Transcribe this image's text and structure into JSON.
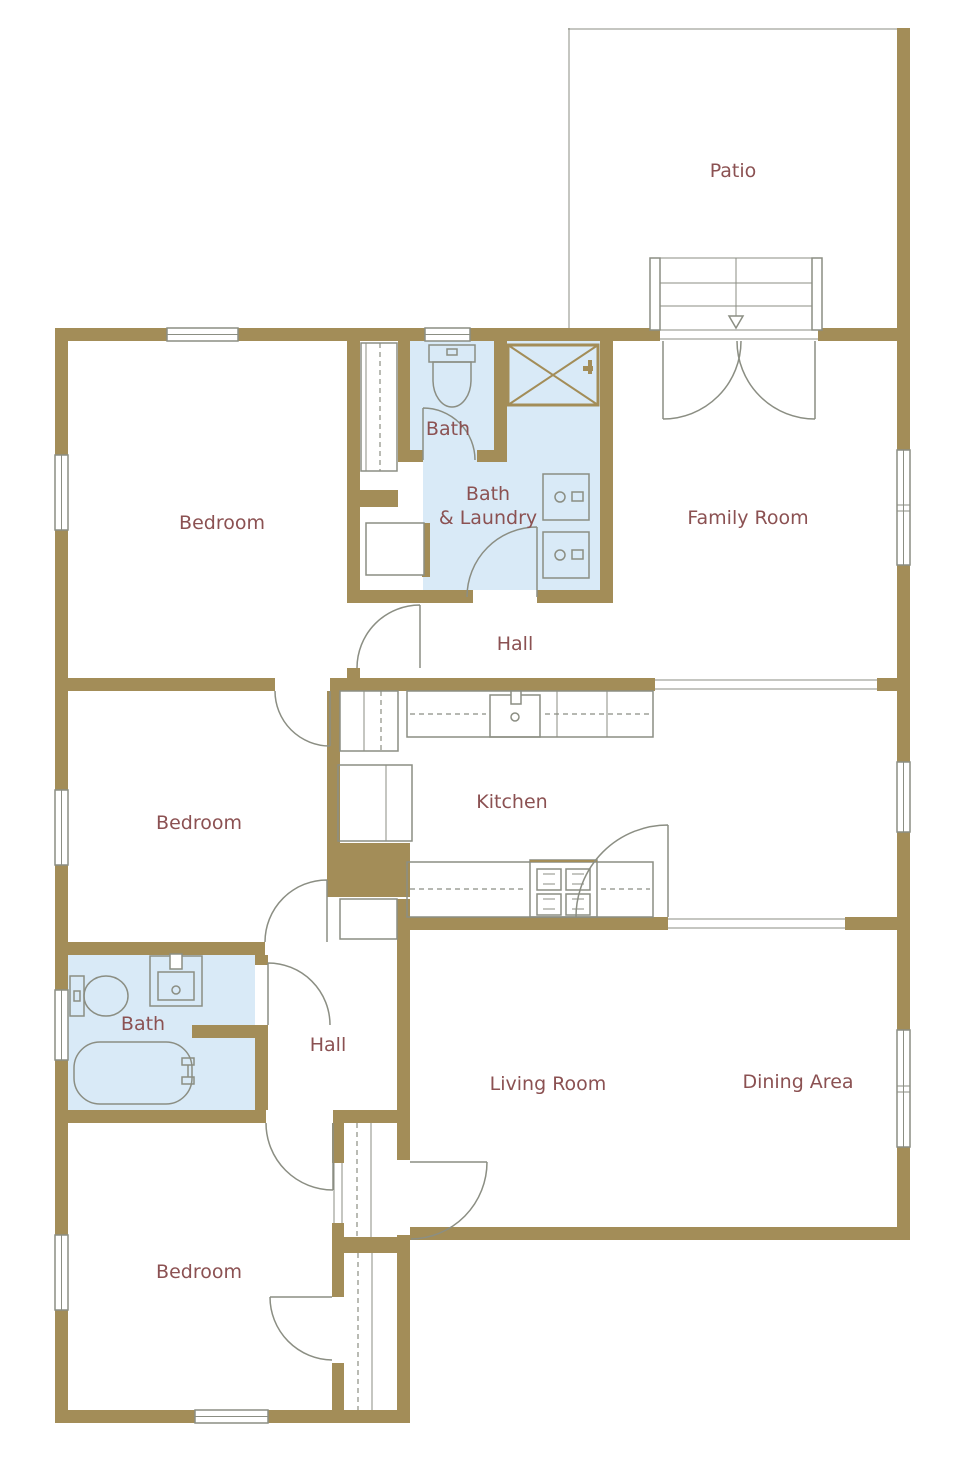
{
  "floor_plan": {
    "rooms": {
      "patio": {
        "label": "Patio"
      },
      "bedroom_top": {
        "label": "Bedroom"
      },
      "bath_top": {
        "label": "Bath"
      },
      "bath_laundry": {
        "label_line1": "Bath",
        "label_line2": "& Laundry"
      },
      "family_room": {
        "label": "Family Room"
      },
      "hall_top": {
        "label": "Hall"
      },
      "kitchen": {
        "label": "Kitchen"
      },
      "bedroom_middle": {
        "label": "Bedroom"
      },
      "bath_bottom": {
        "label": "Bath"
      },
      "hall_bottom": {
        "label": "Hall"
      },
      "living_room": {
        "label": "Living Room"
      },
      "dining_area": {
        "label": "Dining Area"
      },
      "bedroom_bottom": {
        "label": "Bedroom"
      }
    },
    "colors": {
      "wall": "#A38D58",
      "wet_room_fill": "#D9EAF7",
      "label_text": "#8B5152",
      "fixture_line": "#8B8E83"
    }
  }
}
